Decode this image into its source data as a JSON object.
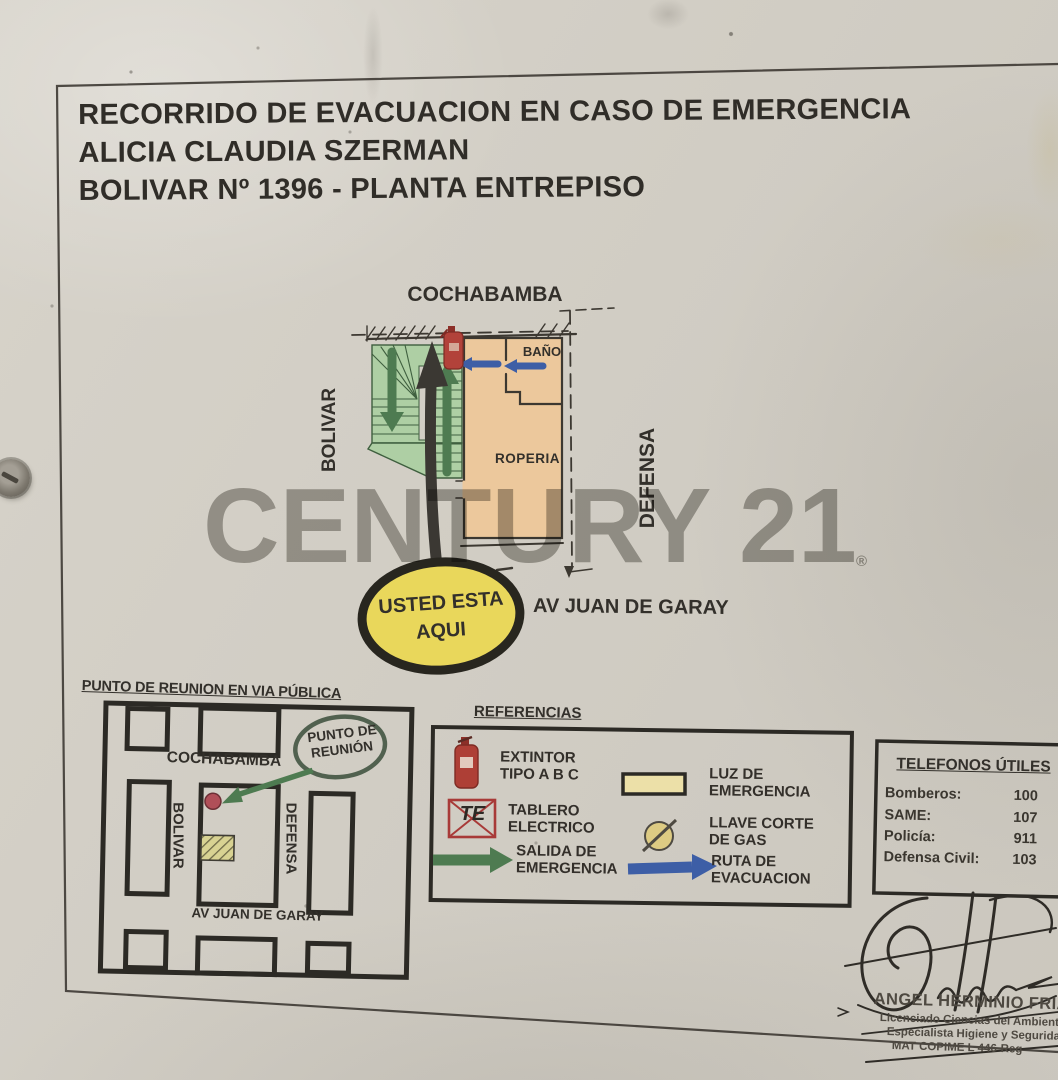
{
  "document": {
    "title_line1": "RECORRIDO DE EVACUACION EN CASO DE EMERGENCIA",
    "title_line2": "ALICIA CLAUDIA SZERMAN",
    "title_line3": "BOLIVAR Nº 1396 - PLANTA ENTREPISO"
  },
  "floorplan": {
    "street_top": "COCHABAMBA",
    "street_left": "BOLIVAR",
    "street_right": "DEFENSA",
    "street_bottom": "AV JUAN DE GARAY",
    "rooms": {
      "bathroom": "BAÑO",
      "laundry": "ROPERIA"
    },
    "you_are_here_line1": "USTED ESTA",
    "you_are_here_line2": "AQUI"
  },
  "meeting_map": {
    "title": "PUNTO DE REUNION EN VIA PÚBLICA",
    "street_top": "COCHABAMBA",
    "street_left": "BOLIVAR",
    "street_right": "DEFENSA",
    "street_bottom": "AV JUAN DE GARAY",
    "callout_line1": "PUNTO DE",
    "callout_line2": "REUNIÓN"
  },
  "legend": {
    "title": "REFERENCIAS",
    "items": [
      {
        "icon": "fire-extinguisher-icon",
        "line1": "EXTINTOR",
        "line2": "TIPO A B C"
      },
      {
        "icon": "electrical-panel-icon",
        "line1": "TABLERO",
        "line2": "ELECTRICO",
        "symbol": "TE"
      },
      {
        "icon": "green-exit-arrow-icon",
        "line1": "SALIDA DE",
        "line2": "EMERGENCIA"
      },
      {
        "icon": "emergency-light-icon",
        "line1": "LUZ DE",
        "line2": "EMERGENCIA"
      },
      {
        "icon": "gas-valve-icon",
        "line1": "LLAVE CORTE",
        "line2": "DE GAS"
      },
      {
        "icon": "blue-route-arrow-icon",
        "line1": "RUTA DE",
        "line2": "EVACUACION"
      }
    ]
  },
  "phones": {
    "title": "TELEFONOS ÚTILES",
    "rows": [
      {
        "label": "Bomberos:",
        "value": "100"
      },
      {
        "label": "SAME:",
        "value": "107"
      },
      {
        "label": "Policía:",
        "value": "911"
      },
      {
        "label": "Defensa Civil:",
        "value": "103"
      }
    ]
  },
  "signature": {
    "name": "ANGEL HERMINIO FRIAS",
    "line2": "Licenciado Ciencias del Ambiente",
    "line3": "Especialista Higiene y Seguridad",
    "line4": "MAT COPIME L 446-Reg"
  },
  "watermark": {
    "text": "CENTURY 21",
    "registered": "®"
  },
  "colors": {
    "paper": "#d2cec5",
    "ink": "#33302b",
    "stairs_green": "#aecfa4",
    "arrow_green": "#4e7b51",
    "room_tan": "#ecc89c",
    "route_blue": "#3d5ea6",
    "extinguisher_red": "#ae3f36",
    "you_are_here_yellow": "#e9d75b",
    "legend_yellow": "#ece0a8",
    "meeting_dot_red": "#b04f58"
  }
}
